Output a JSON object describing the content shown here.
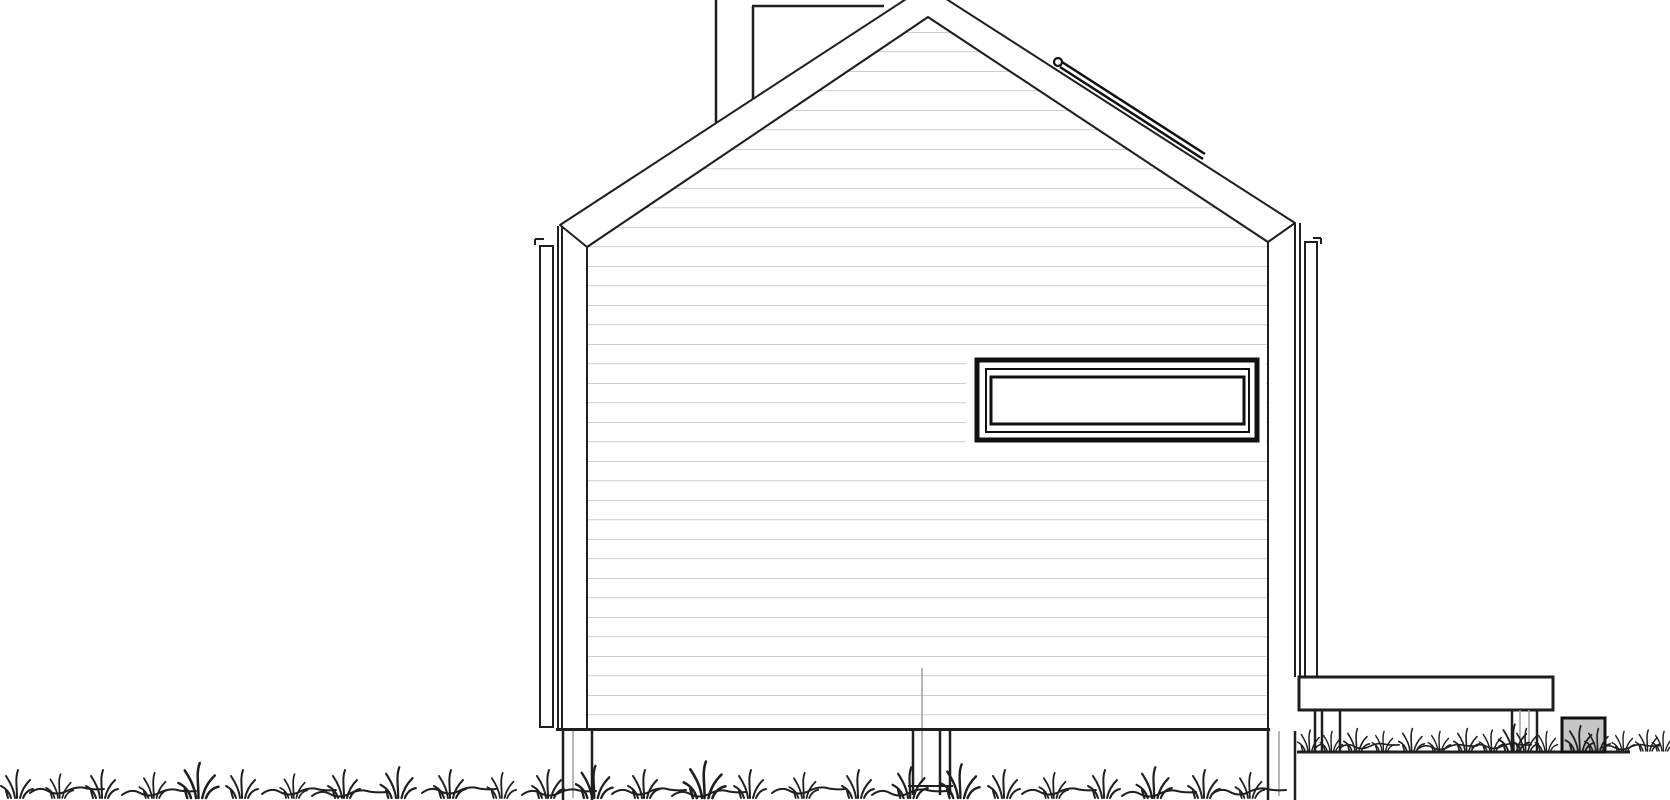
{
  "scene": {
    "type": "architectural-elevation-drawing",
    "subject": "gabled-cabin-side-elevation",
    "text_content": "none"
  },
  "colors": {
    "background": "#ffffff",
    "line": "#1f1f1f",
    "dark": "#111111",
    "faint": "#9e9e9e",
    "siding": "#b5b5b5",
    "rock": "#c6c6c6"
  },
  "components": [
    "cabin-wall-with-siding",
    "gable-roof-fascia",
    "chimney-flue",
    "roof-snow-guard",
    "ribbon-window",
    "corner-trim-left",
    "corner-trim-right",
    "foundation-posts",
    "side-deck",
    "ground-line",
    "stone-block",
    "grass-strips"
  ]
}
